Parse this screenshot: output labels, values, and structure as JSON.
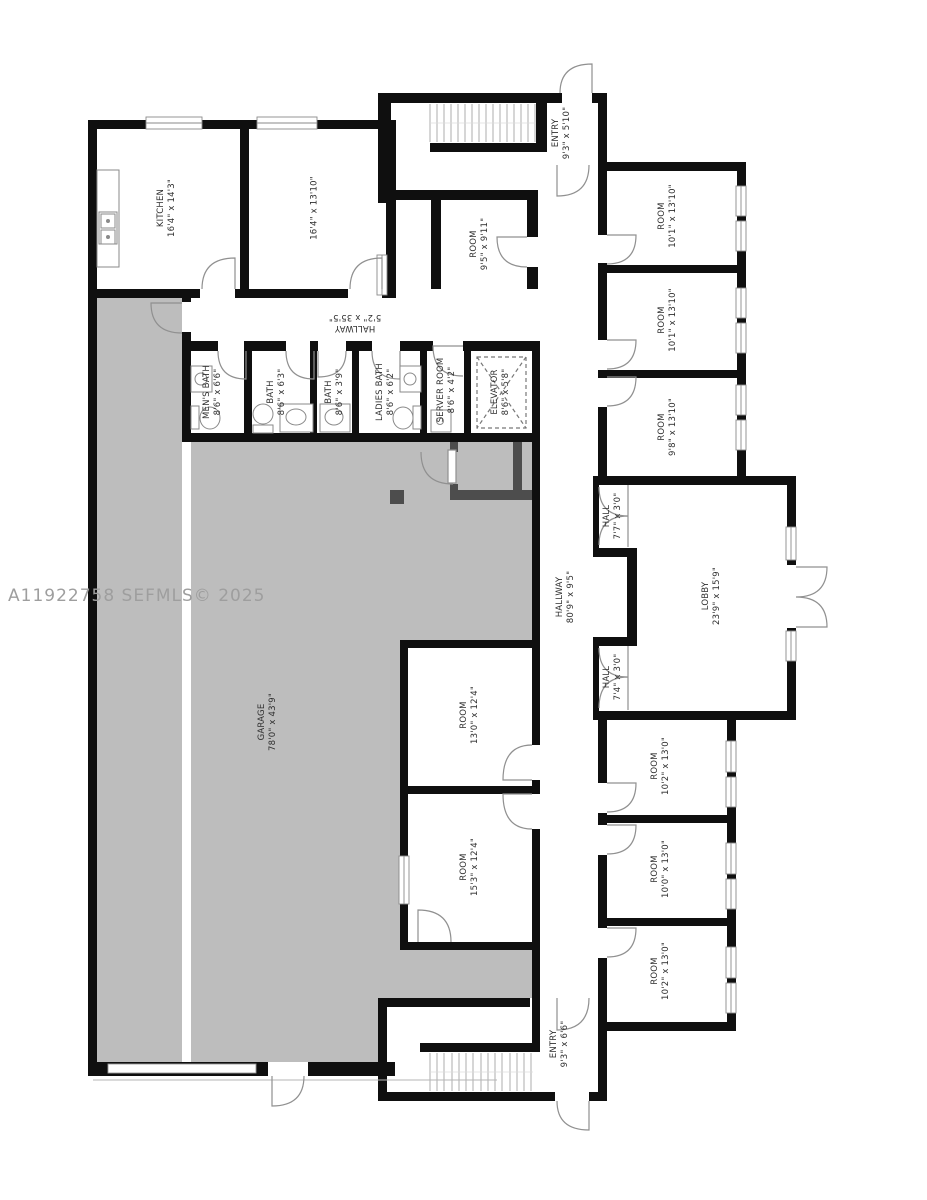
{
  "watermark": "A11922758 SEFMLS© 2025",
  "colors": {
    "wall": "#0f0f0f",
    "garage_fill": "#bdbdbd",
    "partition": "#4d4d4d",
    "door_symbol": "#909090",
    "label_text": "#2e2e2e",
    "watermark_text": "#9e9e9e"
  },
  "rooms": [
    {
      "id": "kitchen",
      "name": "KITCHEN",
      "dims": "16'4\" x 14'3\""
    },
    {
      "id": "room-top-2",
      "name": "",
      "dims": "16'4\" x 13'10\""
    },
    {
      "id": "entry-top",
      "name": "ENTRY",
      "dims": "9'3\" x 5'10\""
    },
    {
      "id": "room-9-5",
      "name": "ROOM",
      "dims": "9'5\" x 9'11\""
    },
    {
      "id": "room-ne-1",
      "name": "ROOM",
      "dims": "10'1\" x 13'10\""
    },
    {
      "id": "room-ne-2",
      "name": "ROOM",
      "dims": "10'1\" x 13'10\""
    },
    {
      "id": "room-ne-3",
      "name": "ROOM",
      "dims": "9'8\" x 13'10\""
    },
    {
      "id": "hallway-top",
      "name": "HALLWAY",
      "dims": "5'2\" x 35'5\""
    },
    {
      "id": "mens-bath",
      "name": "MEN'S BATH",
      "dims": "8'6\" x 6'6\""
    },
    {
      "id": "bath-1",
      "name": "BATH",
      "dims": "8'6\" x 6'3\""
    },
    {
      "id": "bath-2",
      "name": "BATH",
      "dims": "8'6\" x 3'9\""
    },
    {
      "id": "ladies-bath",
      "name": "LADIES BATH",
      "dims": "8'6\" x 6'2\""
    },
    {
      "id": "server-room",
      "name": "SERVER ROOM",
      "dims": "8'6\" x 4'2\""
    },
    {
      "id": "elevator",
      "name": "ELEVATOR",
      "dims": "8'6\" x 5'8\""
    },
    {
      "id": "hall-top",
      "name": "HALL",
      "dims": "7'7\" x 3'0\""
    },
    {
      "id": "lobby",
      "name": "LOBBY",
      "dims": "23'9\" x 15'9\""
    },
    {
      "id": "hall-bottom",
      "name": "HALL",
      "dims": "7'4\" x 3'0\""
    },
    {
      "id": "hallway-main",
      "name": "HALLWAY",
      "dims": "80'9\" x 9'5\""
    },
    {
      "id": "garage",
      "name": "GARAGE",
      "dims": "78'0\" x 43'9\""
    },
    {
      "id": "room-mid-1",
      "name": "ROOM",
      "dims": "13'0\" x 12'4\""
    },
    {
      "id": "room-mid-2",
      "name": "ROOM",
      "dims": "15'3\" x 12'4\""
    },
    {
      "id": "room-se-1",
      "name": "ROOM",
      "dims": "10'2\" x 13'0\""
    },
    {
      "id": "room-se-2",
      "name": "ROOM",
      "dims": "10'0\" x 13'0\""
    },
    {
      "id": "room-se-3",
      "name": "ROOM",
      "dims": "10'2\" x 13'0\""
    },
    {
      "id": "entry-bottom",
      "name": "ENTRY",
      "dims": "9'3\" x 6'6\""
    }
  ]
}
